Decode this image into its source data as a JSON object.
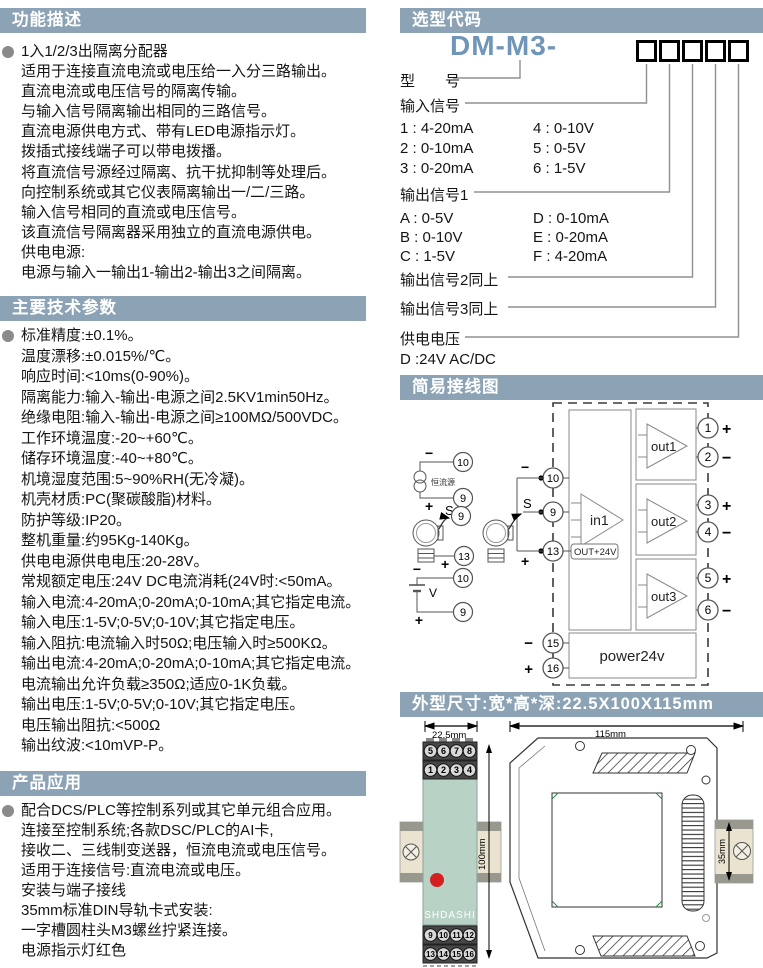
{
  "colors": {
    "header_bg": "#8ca3b5",
    "header_text": "#ffffff",
    "model_code_blue": "#6f96b8",
    "led_red": "#d42020",
    "module_green": "#b9d2c6",
    "rail_tan": "#eae3d0",
    "rail_clip_gray": "#98988e"
  },
  "sections": {
    "function": {
      "title": "功能描述",
      "lines": [
        "1入1/2/3出隔离分配器",
        "适用于连接直流电流或电压给一入分三路输出。",
        "直流电流或电压信号的隔离传输。",
        "与输入信号隔离输出相同的三路信号。",
        "直流电源供电方式、带有LED电源指示灯。",
        "拨插式接线端子可以带电拨播。",
        "将直流信号源经过隔离、抗干扰抑制等处理后。",
        "向控制系统或其它仪表隔离输出一/二/三路。",
        "输入信号相同的直流或电压信号。",
        "该直流信号隔离器采用独立的直流电源供电。",
        "供电电源:",
        "电源与输入一输出1-输出2-输出3之间隔离。"
      ]
    },
    "params": {
      "title": "主要技术参数",
      "lines": [
        "标准精度:±0.1%。",
        "温度漂移:±0.015%/℃。",
        "响应时间:<10ms(0-90%)。",
        "隔离能力:输入-输出-电源之间2.5KV1min50Hz。",
        "绝缘电阻:输入-输出-电源之间≥100MΩ/500VDC。",
        "工作环境温度:-20~+60℃。",
        "储存环境温度:-40~+80℃。",
        "机境湿度范围:5~90%RH(无冷凝)。",
        "机壳材质:PC(聚碳酸脂)材料。",
        "防护等级:IP20。",
        "整机重量:约95Kg-140Kg。",
        "供电电源供电电压:20-28V。",
        "常规额定电压:24V DC电流消耗(24V时:<50mA。",
        "输入电流:4-20mA;0-20mA;0-10mA;其它指定电流。",
        "输入电压:1-5V;0-5V;0-10V;其它指定电压。",
        "输入阻抗:电流输入时50Ω;电压输入时≥500KΩ。",
        "输出电流:4-20mA;0-20mA;0-10mA;其它指定电流。",
        "电流输出允许负载≥350Ω;适应0-1K负载。",
        "输出电压:1-5V;0-5V;0-10V;其它指定电压。",
        "电压输出阻抗:<500Ω",
        "输出纹波:<10mVP-P。"
      ]
    },
    "application": {
      "title": "产品应用",
      "lines": [
        "配合DCS/PLC等控制系列或其它单元组合应用。",
        "连接至控制系统;各款DSC/PLC的AI卡,",
        "接收二、三线制变送器，恒流电流或电压信号。",
        "适用于连接信号:直流电流或电压。",
        "安装与端子接线",
        "35mm标准DIN导轨卡式安装:",
        "一字槽圆柱头M3螺丝拧紧连接。",
        "电源指示灯红色"
      ]
    },
    "ordering": {
      "title": "选型代码",
      "model_prefix": "DM-M3-",
      "code_box_count": 5,
      "labels": {
        "model": "型　　号",
        "input": "输入信号",
        "output1": "输出信号1",
        "output2": "输出信号2同上",
        "output3": "输出信号3同上",
        "power": "供电电压",
        "power_option": "D :24V  AC/DC"
      },
      "input_options": [
        [
          "1 : 4-20mA",
          "4 : 0-10V"
        ],
        [
          "2 : 0-10mA",
          "5 : 0-5V"
        ],
        [
          "3 : 0-20mA",
          "6 : 1-5V"
        ]
      ],
      "output_options": [
        [
          "A : 0-5V",
          "D : 0-10mA"
        ],
        [
          "B : 0-10V",
          "E : 0-20mA"
        ],
        [
          "C : 1-5V",
          "F : 4-20mA"
        ]
      ]
    },
    "wiring": {
      "title": "简易接线图",
      "amp_in": "in1",
      "amp_out1": "out1",
      "amp_out2": "out2",
      "amp_out3": "out3",
      "power_box": "power24v",
      "aux_label": "OUT+24V",
      "ccs_label": "恒流源",
      "volt_label": "V",
      "s_label": "S",
      "plus": "+",
      "minus": "−",
      "module_terminals": [
        "10",
        "9",
        "13",
        "15",
        "16"
      ],
      "output_terminals": [
        "1",
        "2",
        "3",
        "4",
        "5",
        "6"
      ],
      "output_signs": [
        "+",
        "−",
        "+",
        "−",
        "+",
        "−"
      ],
      "ccs_terminals": [
        "10",
        "9"
      ],
      "tx_terminals": [
        "9",
        "13"
      ],
      "volt_terminals": [
        "10",
        "9"
      ]
    },
    "dimensions": {
      "title": "外型尺寸:宽*高*深:22.5X100X115mm",
      "front_width": "22.5mm",
      "front_height": "100mm",
      "side_width": "115mm",
      "rail_height": "35mm",
      "brand": "SHDASHI",
      "top_terminals": [
        "5",
        "6",
        "7",
        "8"
      ],
      "second_terminals": [
        "1",
        "2",
        "3",
        "4"
      ],
      "third_terminals": [
        "9",
        "10",
        "11",
        "12"
      ],
      "bottom_terminals": [
        "13",
        "14",
        "15",
        "16"
      ]
    }
  }
}
